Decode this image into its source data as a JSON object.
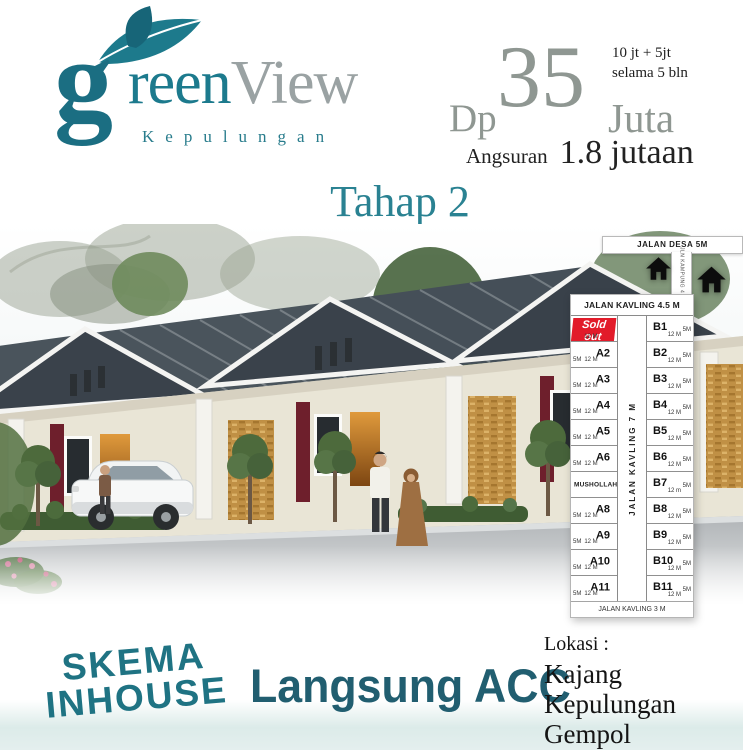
{
  "brand": {
    "initial": "g",
    "rest": "reen",
    "word_view": "View",
    "subtitle": "Kepulungan"
  },
  "phase_label": "Tahap 2",
  "pricing": {
    "dp_prefix": "Dp",
    "dp_value": "35",
    "dp_suffix": "Juta",
    "note_line1": "10 jt + 5jt",
    "note_line2": "selama 5 bln",
    "installment_prefix": "Angsuran",
    "installment_value": "1.8 jutaan"
  },
  "siteplan": {
    "road_top": "JALAN DESA 5M",
    "road_side": "JLN KAMPUNG 4 M",
    "road_header": "JALAN KAVLING 4.5 M",
    "road_center": "JALAN KAVLING 7 M",
    "road_bottom": "JALAN KAVLING 3 M",
    "col_a": [
      {
        "label": "Sold out",
        "depth": "12 M",
        "sold": true
      },
      {
        "label": "A2",
        "width": "5M",
        "depth": "12 M"
      },
      {
        "label": "A3",
        "width": "5M",
        "depth": "12 M"
      },
      {
        "label": "A4",
        "width": "5M",
        "depth": "12 M"
      },
      {
        "label": "A5",
        "width": "5M",
        "depth": "12 M"
      },
      {
        "label": "A6",
        "width": "5M",
        "depth": "12 M"
      },
      {
        "label": "MUSHOLLAH"
      },
      {
        "label": "A8",
        "width": "5M",
        "depth": "12 M"
      },
      {
        "label": "A9",
        "width": "5M",
        "depth": "12 M"
      },
      {
        "label": "A10",
        "width": "5M",
        "depth": "12 M"
      },
      {
        "label": "A11",
        "width": "5M",
        "depth": "12 M"
      }
    ],
    "col_b": [
      {
        "label": "B1",
        "width": "5M",
        "depth": "12 M"
      },
      {
        "label": "B2",
        "width": "5M",
        "depth": "12 M"
      },
      {
        "label": "B3",
        "width": "5M",
        "depth": "12 M"
      },
      {
        "label": "B4",
        "width": "5M",
        "depth": "12 M"
      },
      {
        "label": "B5",
        "width": "5M",
        "depth": "12 M"
      },
      {
        "label": "B6",
        "width": "5M",
        "depth": "12 M"
      },
      {
        "label": "B7",
        "width": "5M",
        "depth": "12 m"
      },
      {
        "label": "B8",
        "width": "5M",
        "depth": "12 M"
      },
      {
        "label": "B9",
        "width": "5M",
        "depth": "12 M"
      },
      {
        "label": "B10",
        "width": "5M",
        "depth": "12 M"
      },
      {
        "label": "B11",
        "width": "5M",
        "depth": "12 M"
      }
    ]
  },
  "footer": {
    "scheme_line1": "SKEMA",
    "scheme_line2": "INHOUSE",
    "approval": "Langsung ACC",
    "location_label": "Lokasi :",
    "location_line1": "Kajang Kepulungan",
    "location_line2": "Gempol"
  },
  "colors": {
    "teal": "#1C7A8D",
    "dark_teal": "#215E70",
    "gray": "#8F9792",
    "sold_red": "#E21B2A",
    "roof_slate": "#3A424B",
    "accent_maroon": "#6E1F2C",
    "stone": "#C09045"
  }
}
